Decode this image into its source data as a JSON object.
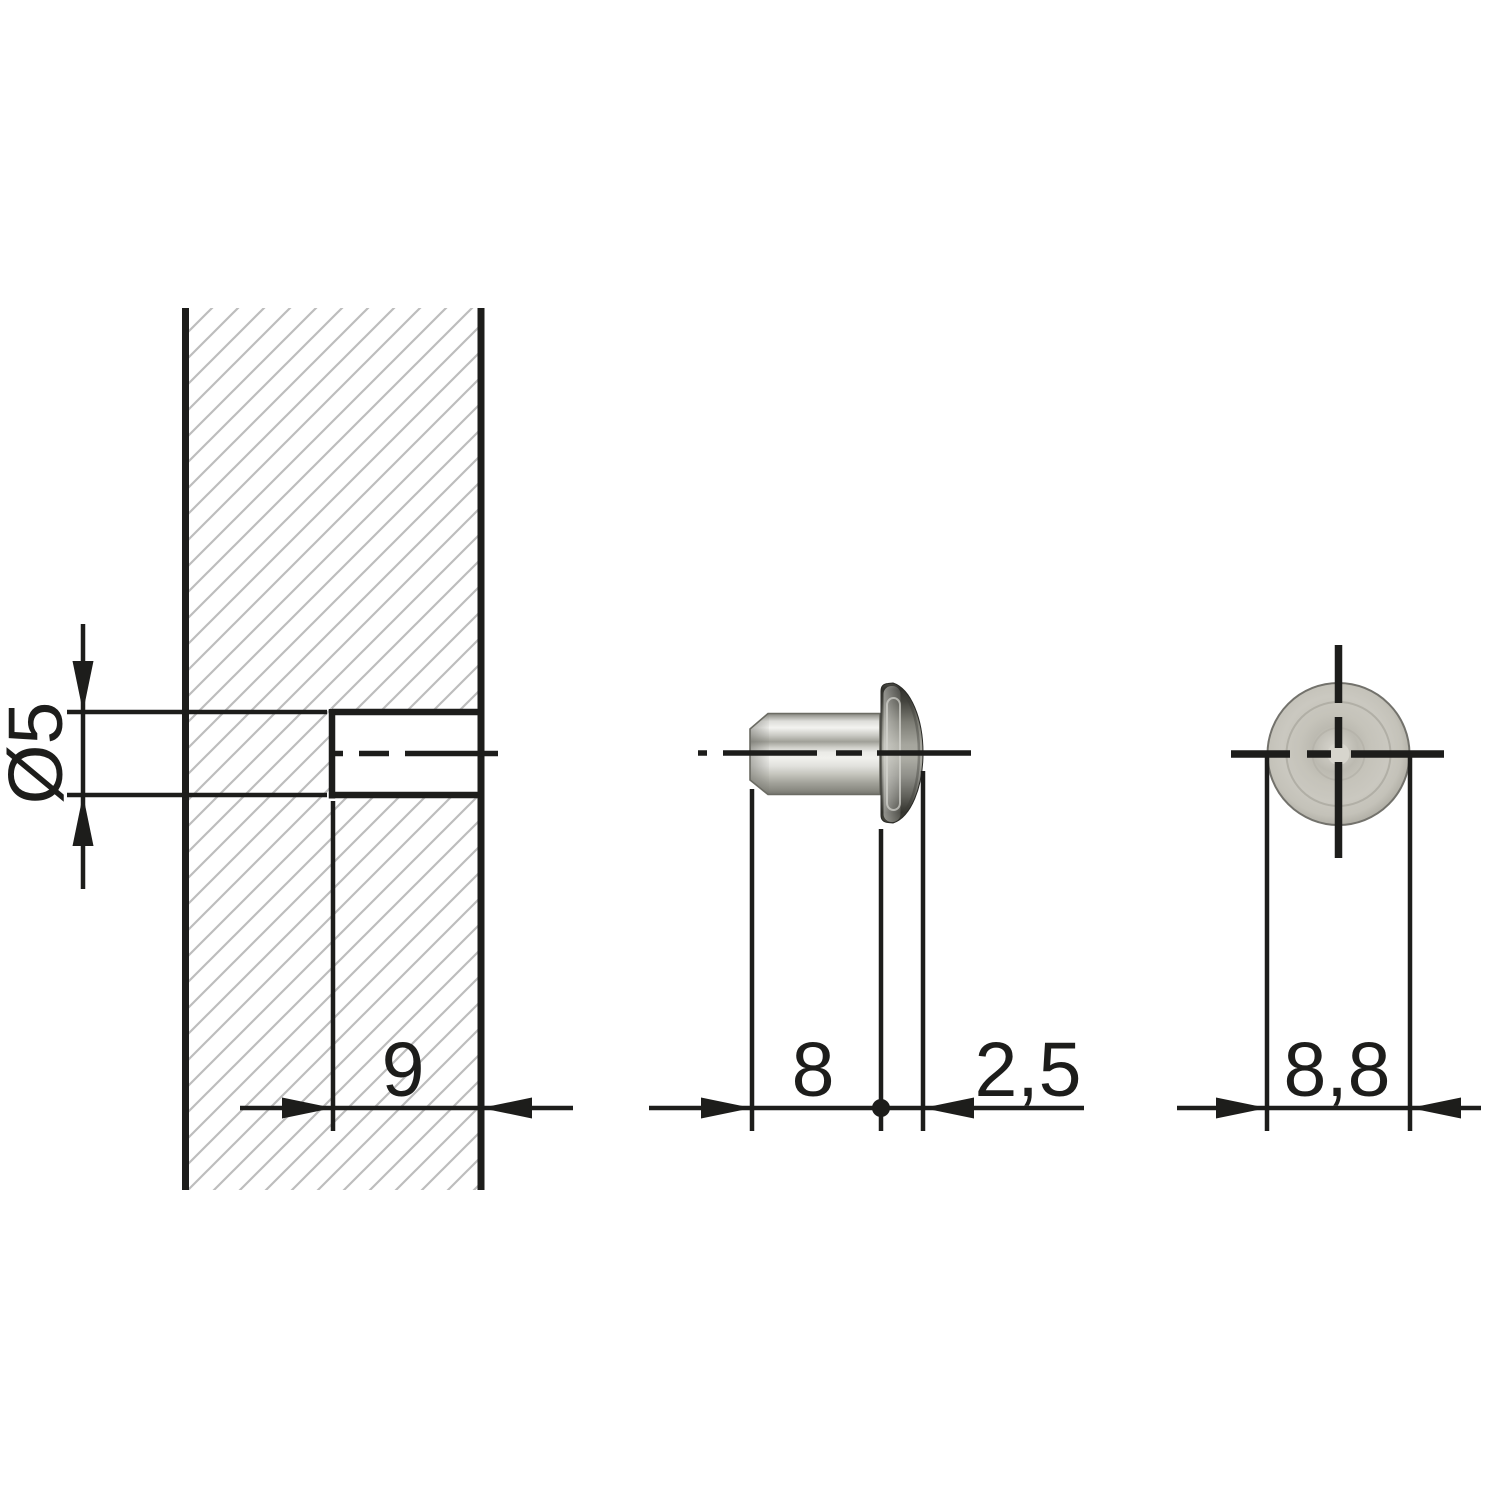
{
  "colors": {
    "bg": "#ffffff",
    "line": "#1d1d1b",
    "hatch": "#bdbdbd",
    "face-fill": "#c7c5bd",
    "body-light": "#ecece8",
    "head-dark": "#3a3a34"
  },
  "views": {
    "panel_section": {
      "labels": {
        "hole_diameter": "Ø5",
        "hole_depth": "9"
      }
    },
    "side_view": {
      "labels": {
        "body_length": "8",
        "head_thickness": "2,5"
      }
    },
    "front_view": {
      "labels": {
        "head_diameter": "8,8"
      }
    }
  }
}
